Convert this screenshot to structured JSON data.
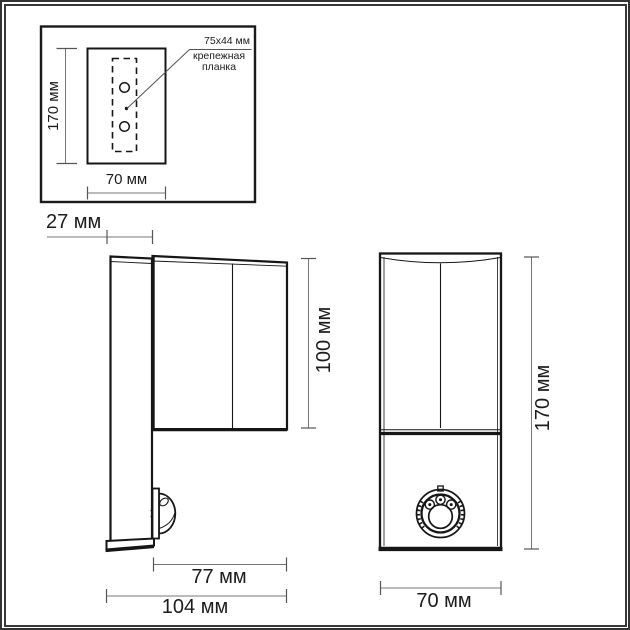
{
  "frame": {
    "outer_color": "#333333",
    "inner_color": "#383838",
    "background": "#ffffff"
  },
  "drawing": {
    "line_color": "#161616",
    "dim_line_color": "#777777",
    "text_color": "#1c1c1c"
  },
  "inset_detail": {
    "height_label": "170 мм",
    "width_label": "70 мм",
    "callout_size": "75x44 мм",
    "callout_line1": "крепежная",
    "callout_line2": "планка"
  },
  "side_view": {
    "back_depth_label": "27 мм",
    "body_height_label": "100 мм",
    "body_depth_label": "77 мм",
    "total_depth_label": "104 мм"
  },
  "front_view": {
    "total_height_label": "170 мм",
    "width_label": "70 мм"
  }
}
